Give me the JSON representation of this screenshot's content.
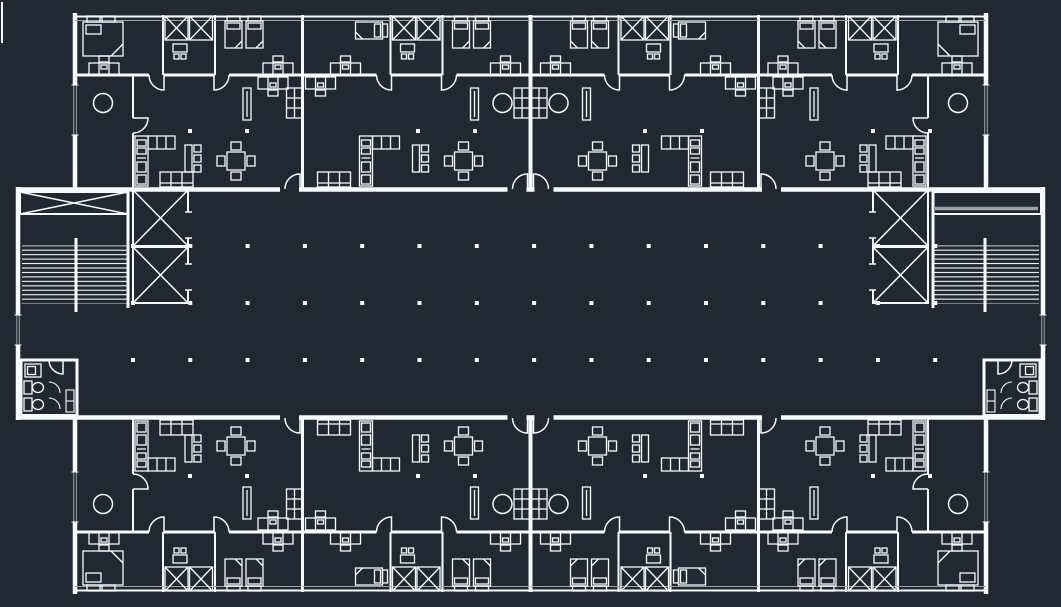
{
  "canvas": {
    "width": 1061,
    "height": 607,
    "background_color": "#222833",
    "line_color": "#f8fafc",
    "muted_line_color": "#99a1ab"
  },
  "drawing": {
    "type": "architectural-floor-plan",
    "theme": "cad-dark",
    "apartment_modules": {
      "top_band": 4,
      "bottom_band": 4
    },
    "cores": {
      "stair_runs": 2,
      "elevator_shafts": 4,
      "wc_rooms": 2
    },
    "column_grid": {
      "x_start": 133,
      "x_step": 57.3,
      "columns": 15,
      "corridor_row_ys": [
        246,
        303,
        360
      ],
      "dot_size": 4
    },
    "room_dots": {
      "xs": [
        190,
        247,
        418,
        475,
        645,
        702,
        873,
        930
      ],
      "y_top": 131,
      "y_bottom": 476
    },
    "furniture_symbols": [
      "double-bed",
      "single-bed",
      "wardrobe-cross",
      "dresser-with-stool",
      "dining-table-with-chairs",
      "sofa",
      "kitchen-unit",
      "kitchen-counter",
      "round-table",
      "shelf-unit",
      "mirror-panel",
      "sideboard-with-stools",
      "toilet",
      "wash-basin",
      "door-swing",
      "stair-hatch",
      "elevator-cross"
    ]
  }
}
